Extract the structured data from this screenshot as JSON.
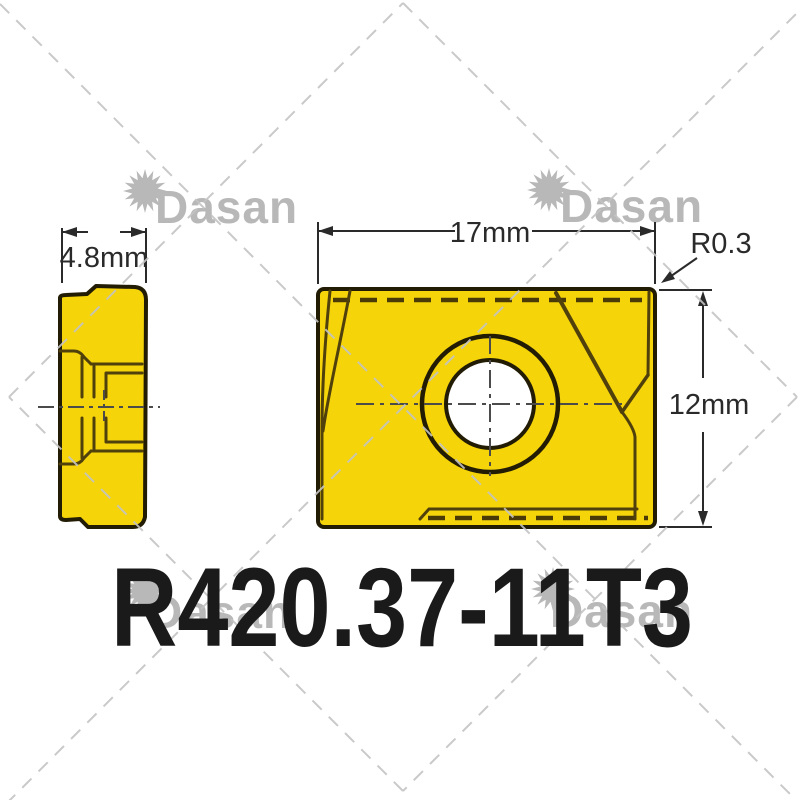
{
  "brand": {
    "name": "Dasan"
  },
  "product": {
    "model": "R420.37-11T3"
  },
  "dimensions": {
    "side_width": "4.8mm",
    "front_width": "17mm",
    "front_height": "12mm",
    "corner_radius": "R0.3"
  },
  "colors": {
    "insert_yellow": "#f5d40a",
    "outline_dark": "#231c05",
    "inner_line": "#50400c",
    "watermark_gray": "#b5b5b5",
    "dimension_dark": "#2a2a2a",
    "hole_white": "#ffffff",
    "title_black": "#1a1a1a"
  }
}
